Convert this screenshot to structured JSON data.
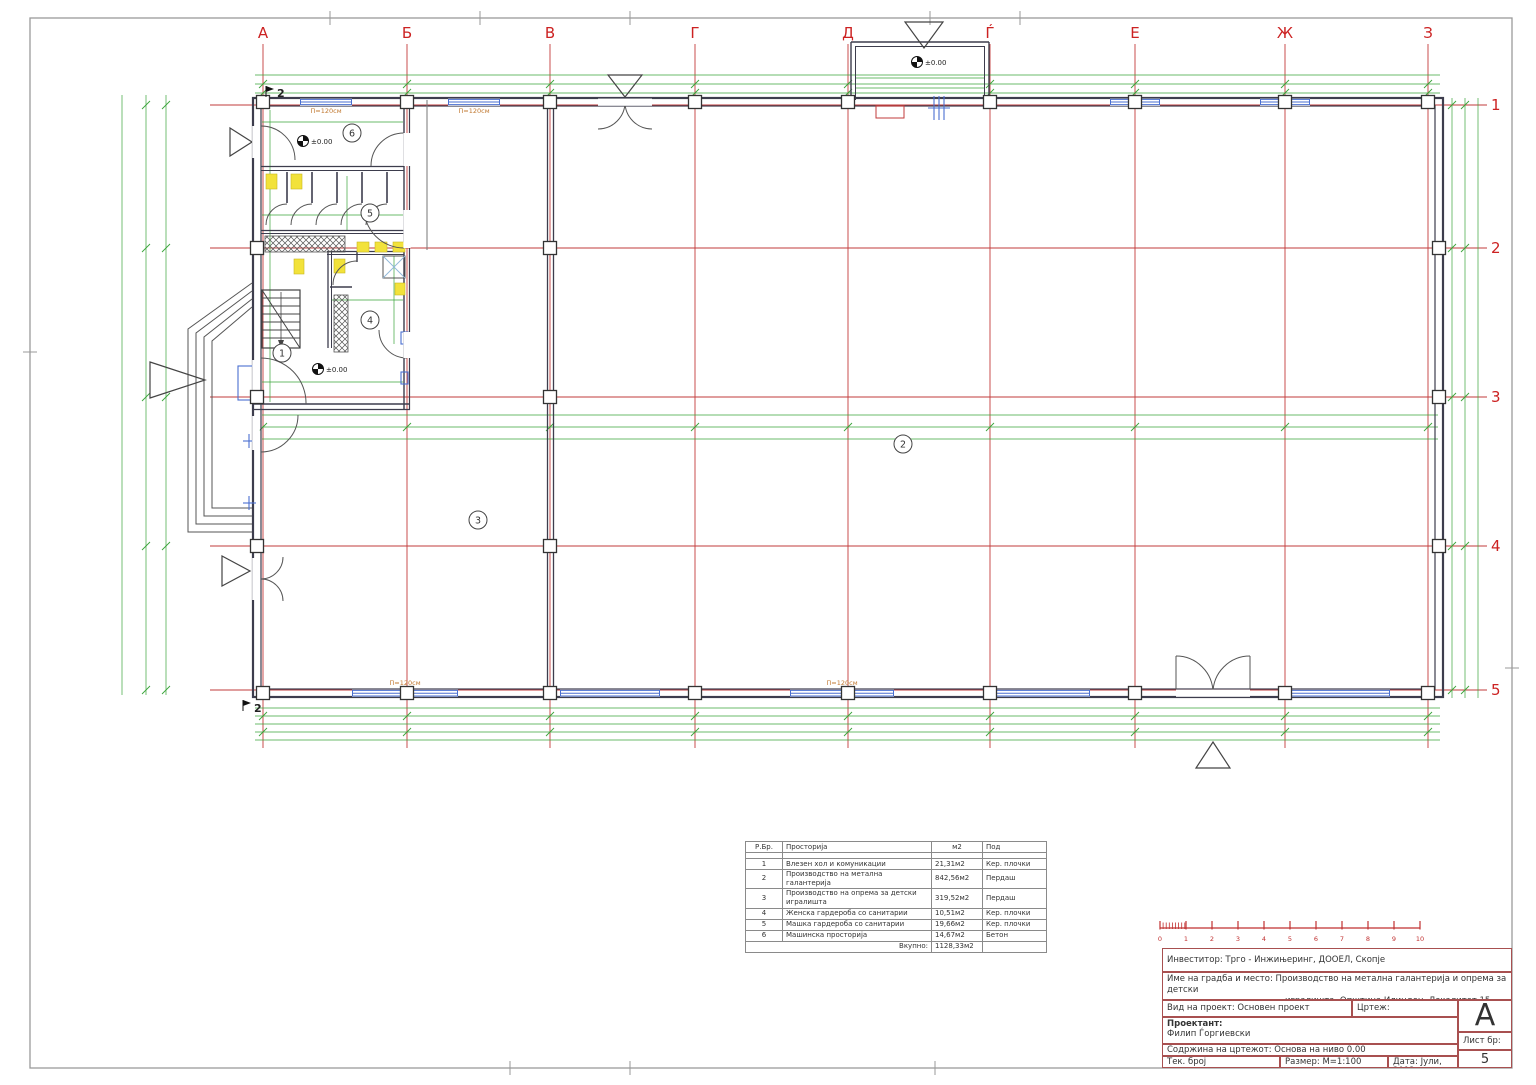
{
  "axes": {
    "cols": [
      "А",
      "Б",
      "В",
      "Г",
      "Д",
      "Ѓ",
      "Е",
      "Ж",
      "З"
    ],
    "rows": [
      "1",
      "2",
      "3",
      "4",
      "5"
    ]
  },
  "rooms": {
    "labels": [
      "1",
      "2",
      "3",
      "4",
      "5",
      "6"
    ]
  },
  "annotations": {
    "level_zero": "±0.00",
    "window_label": "П=120см",
    "section_mark": "2"
  },
  "scale_bar": {
    "numbers": [
      "0",
      "1",
      "2",
      "3",
      "4",
      "5",
      "6",
      "7",
      "8",
      "9",
      "10"
    ]
  },
  "room_table": {
    "headers": [
      "Р.Бр.",
      "Просторија",
      "м2",
      "Под"
    ],
    "rows": [
      {
        "num": "1",
        "name": "Влезен хол и комуникации",
        "area": "21,31м2",
        "floor": "Кер. плочки"
      },
      {
        "num": "2",
        "name": "Производство на метална галантерија",
        "area": "842,56м2",
        "floor": "Пердаш"
      },
      {
        "num": "3",
        "name": "Производство на опрема за детски игралишта",
        "area": "319,52м2",
        "floor": "Пердаш"
      },
      {
        "num": "4",
        "name": "Женска гардероба со санитарии",
        "area": "10,51м2",
        "floor": "Кер. плочки"
      },
      {
        "num": "5",
        "name": "Машка гардероба со санитарии",
        "area": "19,66м2",
        "floor": "Кер. плочки"
      },
      {
        "num": "6",
        "name": "Машинска просторија",
        "area": "14,67м2",
        "floor": "Бетон"
      }
    ],
    "total_label": "Вкупно:",
    "total_area": "1128,33м2"
  },
  "title_block": {
    "investor": "Инвеститор: Трго - Инжињеринг, ДООЕЛ, Скопје",
    "project_line1": "Име на градба и место: Производство на метална галантерија и опрема за детски",
    "project_line2": "игралишта, Општина Илинден, Локалитет 15, ГП 15.11, Скопје",
    "project_type": "Вид на проект: Основен проект",
    "drawing": "Цртеж: Архитектонски проект",
    "designer_label": "Проектант:",
    "designer_name": "Филип Ѓоргиевски",
    "content": "Содржина на цртежот: Основа на ниво 0.00",
    "tech_number": "Тек. број",
    "scale": "Размер:   М=1:100",
    "date": "Дата: Јули, 2012",
    "format_letter": "А",
    "sheet_label": "Лист бр:",
    "sheet_number": "5"
  },
  "colors": {
    "grid_red": "#c23b3b",
    "dimension_green": "#3aa43a",
    "wall_dark": "#3d3d4d",
    "window_blue": "#4a6fd0",
    "fixture_yellow": "#f2e23a",
    "title_border": "#a85050",
    "scale_red": "#c03030"
  }
}
